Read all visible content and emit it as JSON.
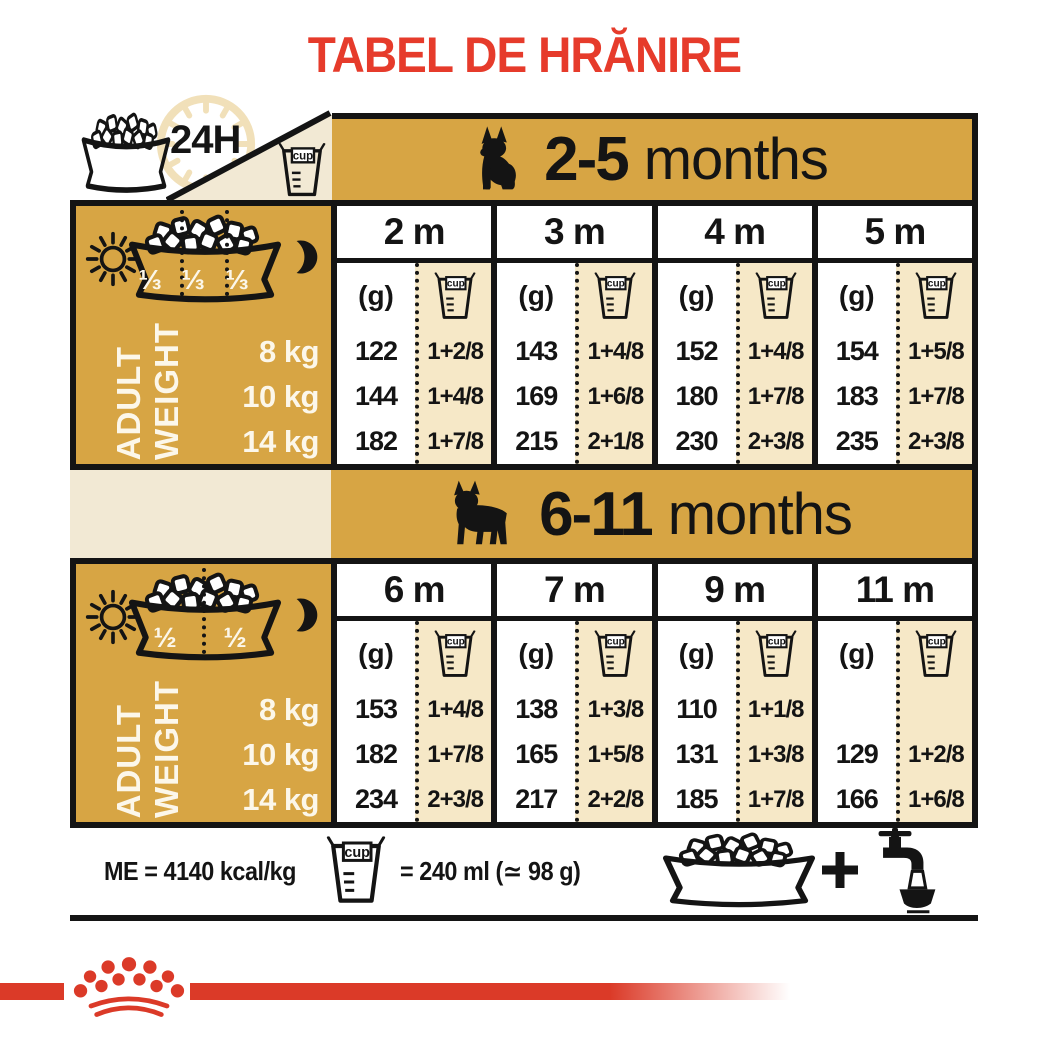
{
  "title": "TABEL DE HRĂNIRE",
  "labels": {
    "hours": "24H",
    "cup": "cup",
    "grams": "(g)",
    "axis_line1": "ADULT",
    "axis_line2": "WEIGHT",
    "weights": [
      "8 kg",
      "10 kg",
      "14 kg"
    ]
  },
  "section1": {
    "banner_bold": "2-5",
    "banner_rest": "months",
    "portions": [
      "⅓",
      "⅓",
      "⅓"
    ],
    "months": [
      {
        "label": "2 m",
        "rows": [
          [
            "122",
            "1+2/8"
          ],
          [
            "144",
            "1+4/8"
          ],
          [
            "182",
            "1+7/8"
          ]
        ]
      },
      {
        "label": "3 m",
        "rows": [
          [
            "143",
            "1+4/8"
          ],
          [
            "169",
            "1+6/8"
          ],
          [
            "215",
            "2+1/8"
          ]
        ]
      },
      {
        "label": "4 m",
        "rows": [
          [
            "152",
            "1+4/8"
          ],
          [
            "180",
            "1+7/8"
          ],
          [
            "230",
            "2+3/8"
          ]
        ]
      },
      {
        "label": "5 m",
        "rows": [
          [
            "154",
            "1+5/8"
          ],
          [
            "183",
            "1+7/8"
          ],
          [
            "235",
            "2+3/8"
          ]
        ]
      }
    ]
  },
  "section2": {
    "banner_bold": "6-11",
    "banner_rest": "months",
    "portions": [
      "½",
      "½"
    ],
    "months": [
      {
        "label": "6 m",
        "rows": [
          [
            "153",
            "1+4/8"
          ],
          [
            "182",
            "1+7/8"
          ],
          [
            "234",
            "2+3/8"
          ]
        ]
      },
      {
        "label": "7 m",
        "rows": [
          [
            "138",
            "1+3/8"
          ],
          [
            "165",
            "1+5/8"
          ],
          [
            "217",
            "2+2/8"
          ]
        ]
      },
      {
        "label": "9 m",
        "rows": [
          [
            "110",
            "1+1/8"
          ],
          [
            "131",
            "1+3/8"
          ],
          [
            "185",
            "1+7/8"
          ]
        ]
      },
      {
        "label": "11 m",
        "rows": [
          [
            "",
            ""
          ],
          [
            "129",
            "1+2/8"
          ],
          [
            "166",
            "1+6/8"
          ]
        ]
      }
    ]
  },
  "footer": {
    "me": "ME = 4140 kcal/kg",
    "cup_eq": "= 240 ml (≃ 98 g)"
  },
  "colors": {
    "gold": "#D7A544",
    "cream": "#F6E8C7",
    "title_red": "#E63B2B",
    "logo_red": "#DB3A28"
  }
}
